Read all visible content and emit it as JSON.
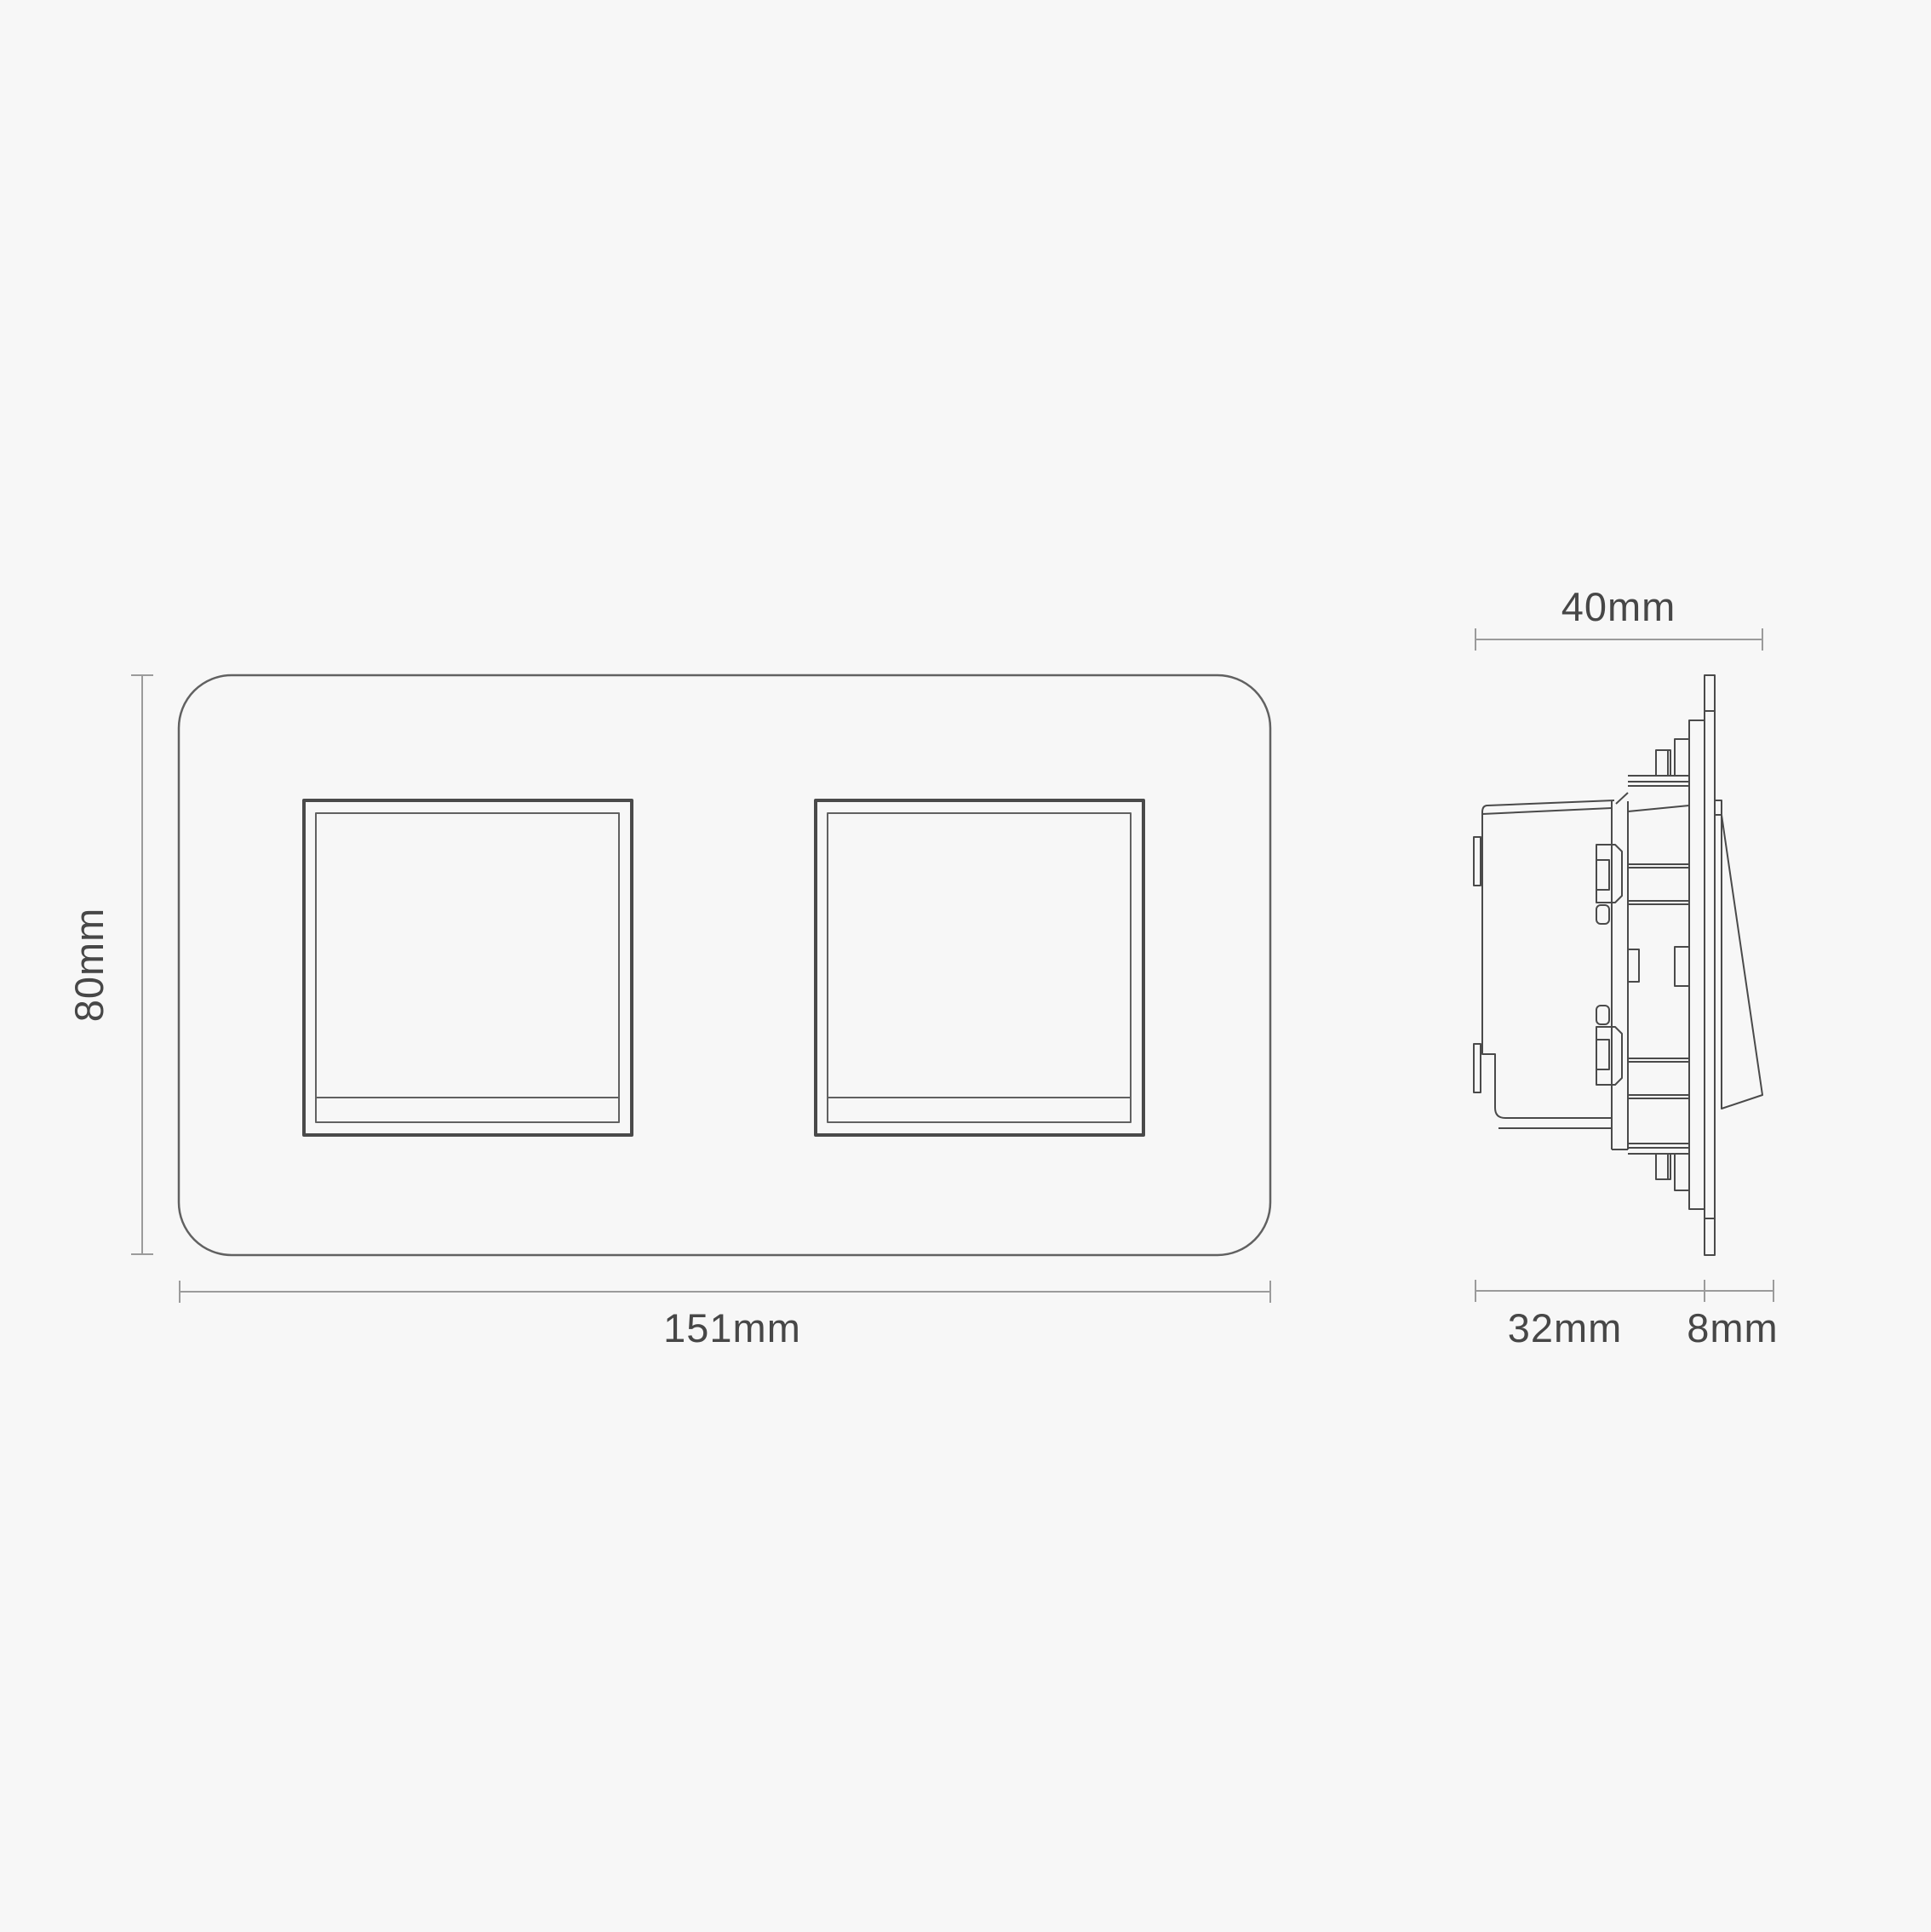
{
  "labels": {
    "front_height": "80mm",
    "front_width": "151mm",
    "side_total_depth": "40mm",
    "side_box_depth": "32mm",
    "side_plate_depth": "8mm"
  },
  "dimensions_mm": {
    "plate_width": 151,
    "plate_height": 80,
    "total_depth": 40,
    "box_depth": 32,
    "plate_depth": 8
  },
  "colors": {
    "background": "#f7f7f7",
    "line_dark": "#4a4a4a",
    "line": "#616161",
    "dim": "#9b9b9b",
    "text": "#474747"
  }
}
